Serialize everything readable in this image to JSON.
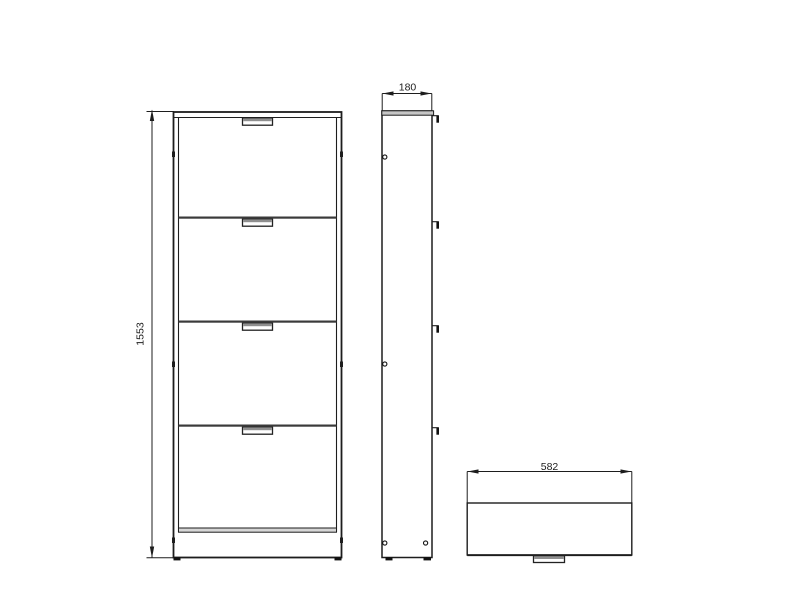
{
  "background": "#ffffff",
  "line_color": "#1d1d1d",
  "shade_color": "#8f8f8f",
  "views": {
    "front": {
      "label": "front view",
      "flap_count": 4,
      "height_dimension": "1553"
    },
    "side": {
      "label": "side view",
      "depth_dimension": "180"
    },
    "top": {
      "label": "top view",
      "width_dimension": "582"
    }
  }
}
